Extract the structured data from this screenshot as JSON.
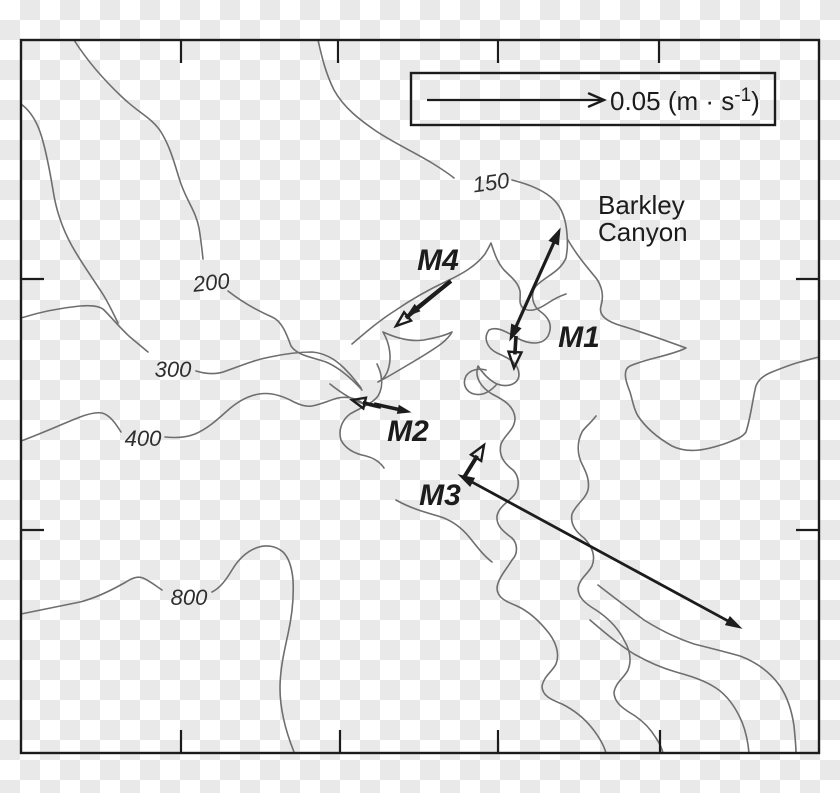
{
  "colors": {
    "ink": "#1c1c1c",
    "contour": "#6e6e6e",
    "checker": "#e9e9e9",
    "background": "#ffffff"
  },
  "legend": {
    "text": "0.05 (m · s",
    "sup": "-1",
    "close": ")",
    "box": {
      "x": 411,
      "y": 73,
      "width": 364,
      "height": 52
    },
    "arrow": {
      "x1": 427,
      "y1": 100,
      "x2": 604,
      "y2": 100,
      "width": 2.2,
      "head_end": "vee",
      "head_len": 15,
      "head_w": 13
    }
  },
  "place": {
    "line1": "Barkley",
    "line2": "Canyon"
  },
  "frame": {
    "x": 21,
    "y": 40,
    "width": 798,
    "height": 713
  },
  "ticks": {
    "length": 22,
    "top": [
      181,
      338,
      498,
      659
    ],
    "bottom": [
      181,
      340,
      498,
      660
    ],
    "left": [
      279,
      530
    ],
    "right": [
      279,
      530
    ]
  },
  "contour_labels": [
    {
      "text": "150",
      "depth_m": 150
    },
    {
      "text": "200",
      "depth_m": 200
    },
    {
      "text": "300",
      "depth_m": 300
    },
    {
      "text": "400",
      "depth_m": 400
    },
    {
      "text": "800",
      "depth_m": 800
    }
  ],
  "moorings": [
    {
      "id": "M1",
      "label": "M1",
      "vectors": [
        {
          "x1": 560,
          "y1": 229,
          "x2": 510,
          "y2": 340,
          "width": 3.2,
          "head_start": "filled",
          "head_end": "filled",
          "head_len": 15,
          "head_w": 10
        },
        {
          "x1": 516,
          "y1": 336,
          "x2": 514,
          "y2": 368,
          "width": 3.6,
          "head_end": "open",
          "head_len": 16,
          "head_w": 13
        }
      ]
    },
    {
      "id": "M2",
      "label": "M2",
      "vectors": [
        {
          "x1": 381,
          "y1": 407,
          "x2": 352,
          "y2": 400,
          "width": 3.6,
          "head_end": "open",
          "head_len": 13,
          "head_w": 11
        },
        {
          "x1": 374,
          "y1": 404,
          "x2": 410,
          "y2": 412,
          "width": 3.6,
          "head_end": "filled",
          "head_len": 12,
          "head_w": 8
        }
      ]
    },
    {
      "id": "M3",
      "label": "M3",
      "vectors": [
        {
          "x1": 459,
          "y1": 475,
          "x2": 741,
          "y2": 628,
          "width": 2.8,
          "head_start": "filled",
          "head_end": "filled",
          "head_len": 15,
          "head_w": 9
        },
        {
          "x1": 463,
          "y1": 479,
          "x2": 484,
          "y2": 445,
          "width": 4,
          "head_end": "open",
          "head_len": 15,
          "head_w": 12
        }
      ]
    },
    {
      "id": "M4",
      "label": "M4",
      "vectors": [
        {
          "x1": 451,
          "y1": 281,
          "x2": 407,
          "y2": 316,
          "width": 4,
          "head_end": "filled",
          "head_len": 13,
          "head_w": 8
        },
        {
          "x1": 447,
          "y1": 284,
          "x2": 396,
          "y2": 326,
          "width": 4,
          "head_end": "open",
          "head_len": 15,
          "head_w": 11
        }
      ]
    }
  ],
  "contours": [
    {
      "name": "nw-diagonal-200-west",
      "d": "M 74 40 C 88 62 104 80 122 97 C 140 114 152 118 161 132 C 171 148 175 166 181 184 C 188 203 196 212 199 228 C 201 240 202 250 203 259"
    },
    {
      "name": "200-east",
      "d": "M 228 291 C 242 302 256 310 272 317 C 282 321 287 335 291 346 C 298 356 312 357 326 362 C 340 368 352 379 362 390"
    },
    {
      "name": "left-upper",
      "d": "M 21 104 C 32 112 38 124 42 138 C 47 155 50 172 53 190 C 56 210 62 228 72 246 C 82 264 94 280 104 296 C 110 306 114 315 118 323"
    },
    {
      "name": "150-west",
      "d": "M 318 40 C 322 58 326 74 334 90 C 344 108 360 120 376 131 C 394 143 414 152 432 163 C 440 168 448 173 454 178"
    },
    {
      "name": "150-canyon-axis",
      "d": "M 512 180 C 528 184 544 190 554 200 C 562 208 566 220 567 234 C 568 246 567 252 566 258 C 560 272 546 276 536 286 C 530 294 532 306 541 312 C 549 318 553 326 548 336 C 542 346 528 344 517 338 C 507 332 497 326 489 330 C 483 338 487 348 497 353 C 508 358 518 362 519 374 C 519 384 508 388 497 384 C 488 380 482 372 478 366 C 474 378 482 388 492 394 C 504 400 514 406 515 418 C 515 430 505 434 501 444 C 498 456 505 464 513 470 C 519 476 520 486 515 494 C 509 502 499 506 497 516 C 496 526 504 532 512 538 C 518 544 518 554 512 560 C 506 570 498 578 497 588 C 497 598 507 602 517 606 C 530 612 540 622 548 632 C 556 642 560 654 556 664 C 552 672 544 676 542 686 C 542 696 552 700 562 704 C 574 710 584 718 592 728 C 600 738 604 746 606 753"
    },
    {
      "name": "east-rim-meander",
      "d": "M 568 240 C 576 254 586 266 596 278 C 602 286 604 296 601 306 C 598 316 608 322 622 326 C 642 332 664 340 686 348 C 670 356 648 358 630 366 C 622 370 626 382 630 392 C 633 402 634 410 638 416 C 646 428 658 438 672 446 C 688 454 706 450 724 444 C 734 440 742 438 746 432 C 750 420 752 404 755 390 C 756 382 762 376 772 372 C 782 368 792 364 800 362 C 808 360 814 358 819 357"
    },
    {
      "name": "east-wall",
      "d": "M 596 416 C 590 424 584 428 582 432 C 576 444 578 456 582 464 C 586 472 590 480 588 490 C 585 500 576 504 572 514 C 570 524 576 532 584 538 C 592 546 596 556 592 566 C 588 574 580 578 578 588 C 578 598 586 604 596 610 C 608 618 618 628 624 640 C 630 650 632 660 628 670 C 624 678 616 682 614 692 C 614 702 622 708 632 714 C 642 720 650 728 656 738 C 660 744 662 749 663 753"
    },
    {
      "name": "west-wall-connector",
      "d": "M 396 500 C 410 508 424 512 438 516 C 452 520 462 528 470 538 C 478 548 484 556 492 562"
    },
    {
      "name": "narrows-north",
      "d": "M 330 384 C 340 392 352 400 364 404 C 370 406 375 407 380 408"
    },
    {
      "name": "m2-spur",
      "d": "M 377 364 C 382 374 384 386 378 396 C 372 404 360 408 350 414 C 342 420 338 430 341 440 C 346 450 356 454 366 456 C 374 458 380 462 384 468"
    },
    {
      "name": "m4-ridge-upper",
      "d": "M 352 344 C 366 332 380 320 396 310 C 412 299 430 289 447 281 C 462 274 476 266 485 254 C 488 249 490 245 491 243 C 494 252 497 262 504 270 C 511 277 518 282 520 291 C 521 298 518 303 523 308 C 530 313 539 309 548 303 C 554 299 560 296 566 294"
    },
    {
      "name": "m4-lens",
      "d": "M 383 332 C 390 344 392 358 388 370 C 386 376 382 380 378 382 C 386 378 396 372 406 366 C 418 359 430 352 441 344 C 446 340 450 336 452 332 C 444 336 434 338 424 340 C 410 342 396 338 383 332 Z"
    },
    {
      "name": "300-west",
      "d": "M 21 318 C 40 312 60 308 80 306 C 92 305 100 306 104 310 C 112 318 120 328 130 337 C 136 342 142 347 148 352"
    },
    {
      "name": "300-east",
      "d": "M 196 371 C 206 374 216 375 226 371 C 240 366 254 360 270 357 C 284 354 298 352 312 352 C 324 353 334 358 344 368 C 350 374 356 381 361 388"
    },
    {
      "name": "400-west",
      "d": "M 21 441 C 40 434 60 425 80 417 C 88 414 96 412 102 413 C 110 415 116 424 121 432"
    },
    {
      "name": "400-east",
      "d": "M 165 437 C 175 438 185 438 195 434 C 207 429 217 420 227 411 C 237 402 247 396 259 394 C 271 392 283 396 294 402 C 300 405 306 407 312 406 C 322 404 330 400 338 398 C 348 396 356 398 364 404"
    },
    {
      "name": "800-west",
      "d": "M 21 614 C 40 610 60 606 80 602 C 96 598 112 590 126 582 C 132 578 138 576 143 578 C 150 581 156 586 162 590"
    },
    {
      "name": "800-east",
      "d": "M 212 592 C 220 588 226 580 232 570 C 238 560 246 552 256 548 C 266 544 276 546 283 552 C 289 558 292 568 293 580 C 294 598 292 616 288 634 C 284 652 280 670 280 688 C 280 710 286 732 294 752"
    },
    {
      "name": "bottom-right-1",
      "d": "M 598 585 C 612 596 628 608 644 620 C 660 630 676 638 694 644 C 710 648 726 652 740 656 C 756 662 770 672 780 686 C 788 698 792 712 794 726 C 795 736 796 746 796 753"
    },
    {
      "name": "bottom-right-2",
      "d": "M 590 620 C 604 632 618 644 634 654 C 648 662 662 668 676 672 C 690 676 704 680 716 688 C 728 696 736 708 742 722 C 746 732 748 742 749 753"
    },
    {
      "name": "m1-loop",
      "d": "M 497 384 C 490 392 482 396 474 394 C 466 392 462 384 466 376 C 470 370 478 368 486 370"
    }
  ]
}
